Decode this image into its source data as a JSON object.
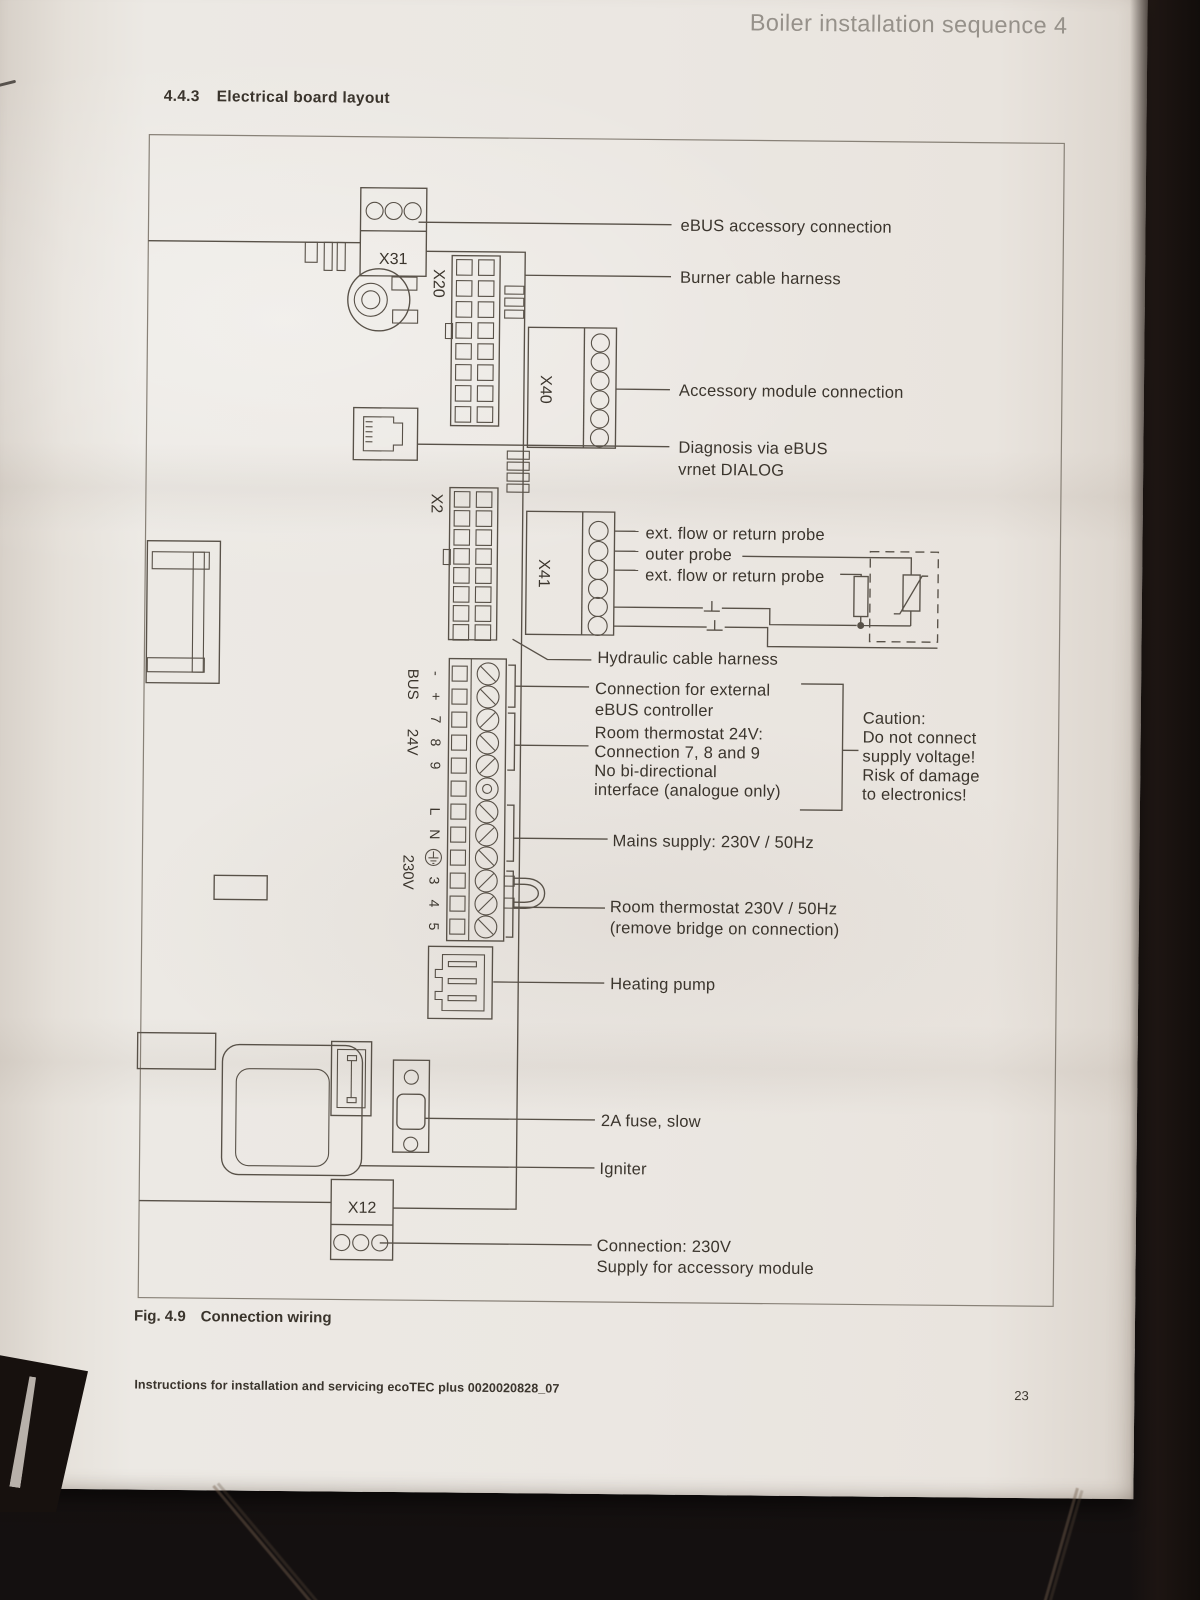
{
  "page": {
    "header": "Boiler installation sequence 4",
    "section_number": "4.4.3",
    "section_title": "Electrical board layout",
    "figure_label": "Fig. 4.9",
    "figure_title": "Connection wiring",
    "footer": "Instructions for installation and servicing ecoTEC plus 0020020828_07",
    "page_number": "23"
  },
  "diagram": {
    "connectors": {
      "x31": "X31",
      "x20": "X20",
      "x40": "X40",
      "x2": "X2",
      "x41": "X41",
      "x12": "X12"
    },
    "terminals": {
      "bus_group": "BUS",
      "bus_pins": [
        "-",
        "+"
      ],
      "lv_group": "24V",
      "lv_pins": [
        "7",
        "8",
        "9"
      ],
      "mains_group": "230V",
      "mains_pins": [
        "L",
        "N",
        "⏚",
        "3",
        "4",
        "5"
      ]
    },
    "callouts": {
      "ebus_accessory": "eBUS accessory connection",
      "burner_harness": "Burner cable harness",
      "accessory_module": "Accessory module connection",
      "diagnosis_1": "Diagnosis via eBUS",
      "diagnosis_2": "vrnet DIALOG",
      "probe_1": "ext. flow or return probe",
      "probe_outer": "outer probe",
      "probe_2": "ext. flow or return probe",
      "hydraulic_harness": "Hydraulic cable harness",
      "ebus_controller_1": "Connection for external",
      "ebus_controller_2": "eBUS controller",
      "room24_1": "Room thermostat 24V:",
      "room24_2": "Connection 7, 8 and 9",
      "room24_3": "No bi-directional",
      "room24_4": "interface (analogue only)",
      "caution_1": "Caution:",
      "caution_2": "Do not connect",
      "caution_3": "supply voltage!",
      "caution_4": "Risk of damage",
      "caution_5": "to electronics!",
      "mains_supply": "Mains supply: 230V / 50Hz",
      "room230_1": "Room thermostat 230V / 50Hz",
      "room230_2": "(remove bridge on connection)",
      "heating_pump": "Heating pump",
      "fuse": "2A fuse, slow",
      "igniter": "Igniter",
      "x12_supply_1": "Connection: 230V",
      "x12_supply_2": "Supply for accessory module"
    },
    "colors": {
      "paper": "#e9e5e0",
      "ink": "#3b352d",
      "line": "#585148"
    }
  }
}
